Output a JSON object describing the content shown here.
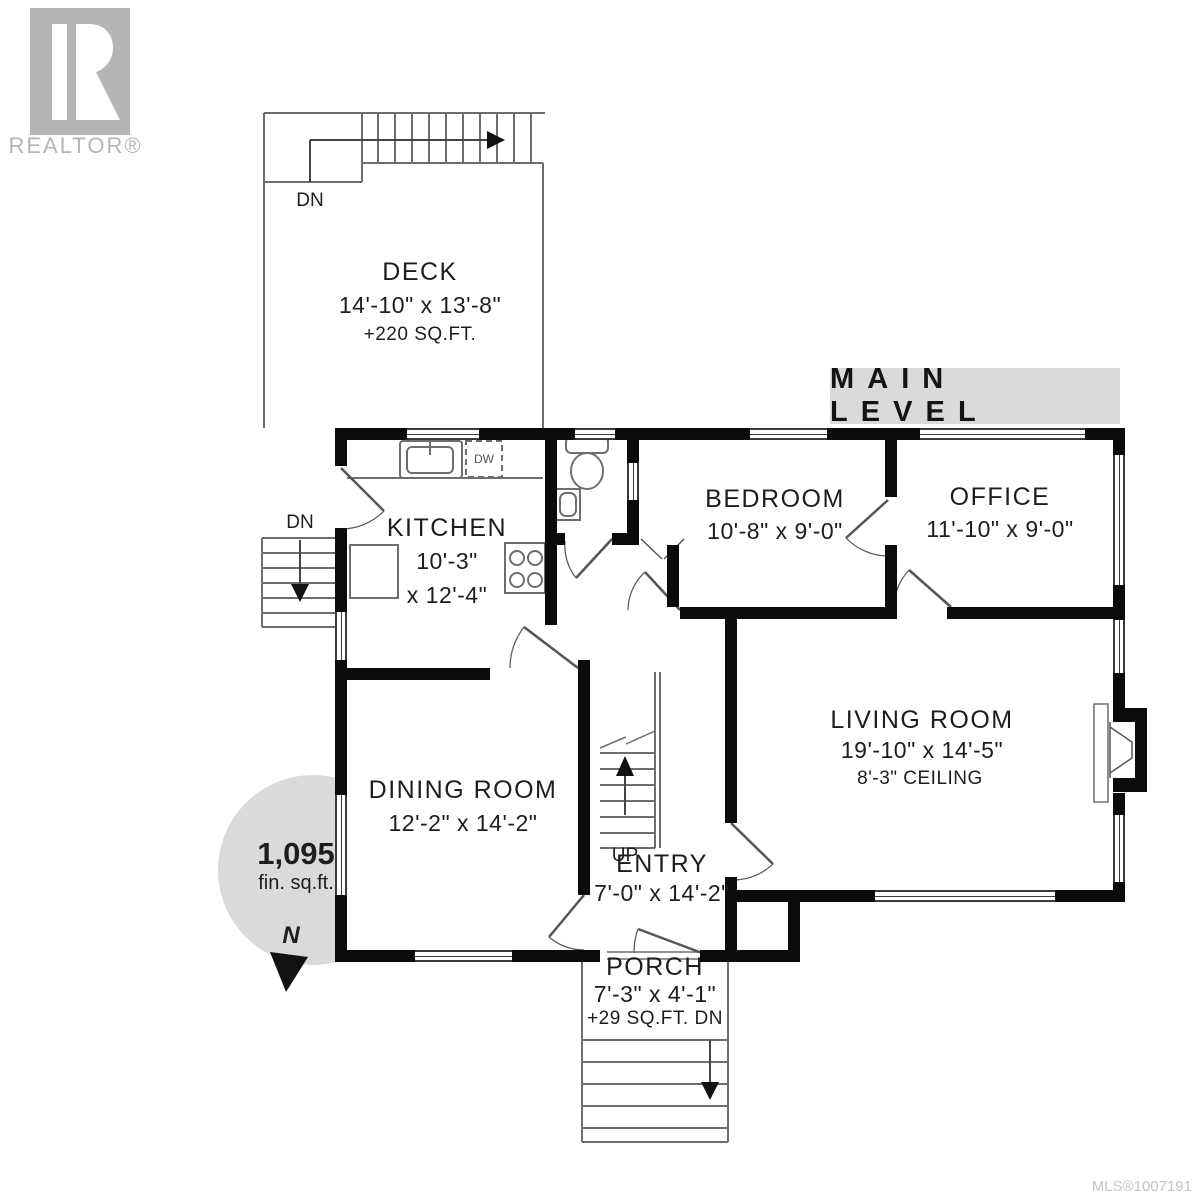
{
  "brand": {
    "name": "REALTOR®"
  },
  "plan": {
    "level_title": "MAIN LEVEL",
    "area": {
      "value": "1,095",
      "unit": "fin. sq.ft."
    },
    "compass": "N",
    "mls": "MLS®1007191"
  },
  "rooms": {
    "deck": {
      "name": "DECK",
      "dims": "14'-10\" x 13'-8\"",
      "note": "+220 SQ.FT."
    },
    "kitchen": {
      "name": "KITCHEN",
      "dims1": "10'-3\"",
      "dims2": "x 12'-4\""
    },
    "bedroom": {
      "name": "BEDROOM",
      "dims": "10'-8\" x 9'-0\""
    },
    "office": {
      "name": "OFFICE",
      "dims": "11'-10\" x 9'-0\""
    },
    "living": {
      "name": "LIVING ROOM",
      "dims": "19'-10\" x 14'-5\"",
      "note": "8'-3\" CEILING"
    },
    "dining": {
      "name": "DINING ROOM",
      "dims": "12'-2\" x 14'-2\""
    },
    "entry": {
      "name": "ENTRY",
      "dims": "7'-0\" x 14'-2\""
    },
    "porch": {
      "name": "PORCH",
      "dims": "7'-3\" x 4'-1\"",
      "note": "+29 SQ.FT. DN"
    }
  },
  "labels": {
    "up": "UP",
    "dn_deck": "DN",
    "dn_side": "DN",
    "dw": "DW"
  }
}
